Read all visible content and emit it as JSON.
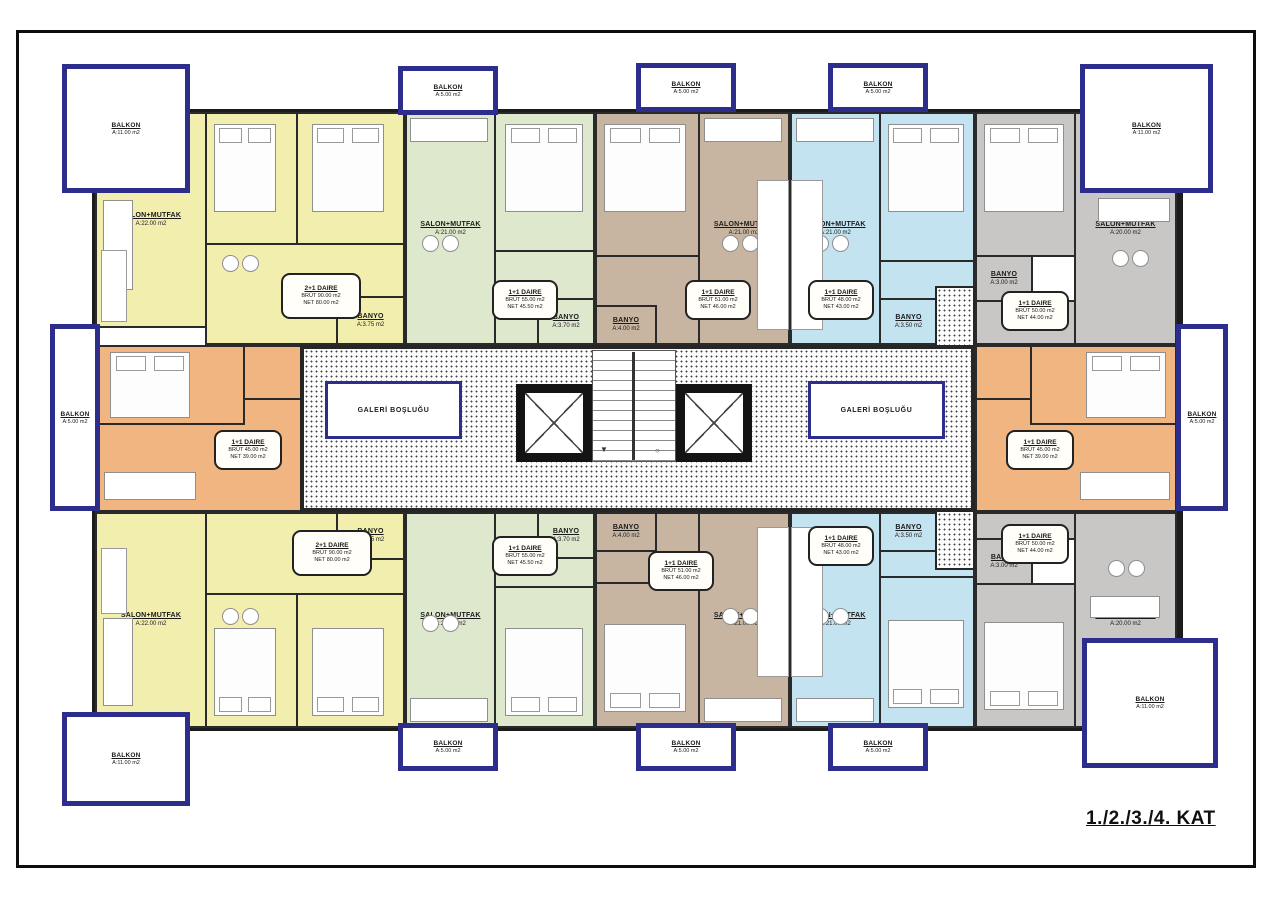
{
  "sheet": {
    "title": "1./2./3./4. KAT"
  },
  "labels": {
    "galeri": "GALERİ BOŞLUĞU"
  },
  "rooms": {
    "yellow_salon": {
      "name": "SALON+MUTFAK",
      "area": "A:22.00 m2"
    },
    "yellow_bed1": {
      "name": "YATAK ODASI",
      "area": "A:12.00 m2"
    },
    "yellow_bed2": {
      "name": "YATAK ODASI",
      "area": "A:14.00 m2"
    },
    "yellow_banyo": {
      "name": "BANYO",
      "area": "A:3.75 m2"
    },
    "green_salon": {
      "name": "SALON+MUTFAK",
      "area": "A:21.00 m2"
    },
    "green_bed": {
      "name": "YATAK ODASI",
      "area": "A:12.70 m2"
    },
    "green_banyo": {
      "name": "BANYO",
      "area": "A:3.70 m2"
    },
    "brown_salon": {
      "name": "SALON+MUTFAK",
      "area": "A:21.00 m2"
    },
    "brown_bed": {
      "name": "YATAK ODASI",
      "area": "A:12.60 m2"
    },
    "brown_banyo": {
      "name": "BANYO",
      "area": "A:4.00 m2"
    },
    "blue_salon": {
      "name": "SALON+MUTFAK",
      "area": "A:21.00 m2"
    },
    "blue_bed": {
      "name": "YATAK ODASI",
      "area": "A:13.00 m2"
    },
    "blue_banyo": {
      "name": "BANYO",
      "area": "A:3.50 m2"
    },
    "gray_salon": {
      "name": "SALON+MUTFAK",
      "area": "A:20.00 m2"
    },
    "gray_bed": {
      "name": "YATAK ODASI",
      "area": "A:11.00 m2"
    },
    "gray_banyo": {
      "name": "BANYO",
      "area": "A:3.00 m2"
    }
  },
  "units": {
    "yellow": {
      "type": "2+1 DAIRE",
      "brut": "BRÜT 90.00 m2",
      "net": "NET 80.00 m2"
    },
    "green": {
      "type": "1+1 DAIRE",
      "brut": "BRÜT 55.00 m2",
      "net": "NET 45.50 m2"
    },
    "brown": {
      "type": "1+1 DAIRE",
      "brut": "BRÜT 51.00 m2",
      "net": "NET 46.00 m2"
    },
    "blue": {
      "type": "1+1 DAIRE",
      "brut": "BRÜT 48.00 m2",
      "net": "NET 43.00 m2"
    },
    "gray": {
      "type": "1+1 DAIRE",
      "brut": "BRÜT 50.00 m2",
      "net": "NET 44.00 m2"
    },
    "orange": {
      "type": "1+1 DAIRE",
      "brut": "BRÜT 45.00 m2",
      "net": "NET 39.00 m2"
    }
  },
  "balconies": {
    "large": {
      "name": "BALKON",
      "area": "A:11.00 m2"
    },
    "small": {
      "name": "BALKON",
      "area": "A:5.00 m2"
    }
  },
  "colors": {
    "yellow": "#f2eeae",
    "green": "#dde8cd",
    "brown": "#c8b5a1",
    "blue": "#c2e3ef",
    "gray": "#c8c7c5",
    "orange": "#f1b581",
    "balcony_navy": "#2d2d8c",
    "wall": "#262626"
  }
}
